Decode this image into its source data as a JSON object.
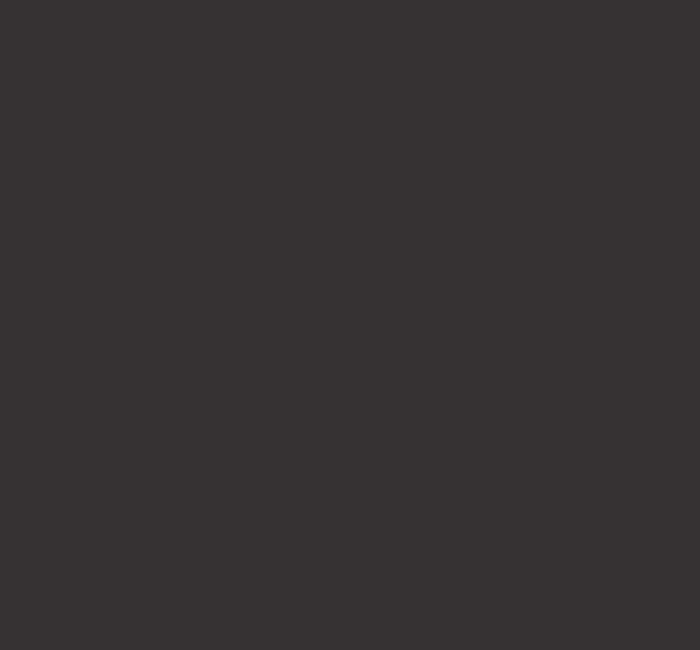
{
  "screen": {
    "description": "blank-empty-screen",
    "background_color": "#363234",
    "visible_text": ""
  }
}
